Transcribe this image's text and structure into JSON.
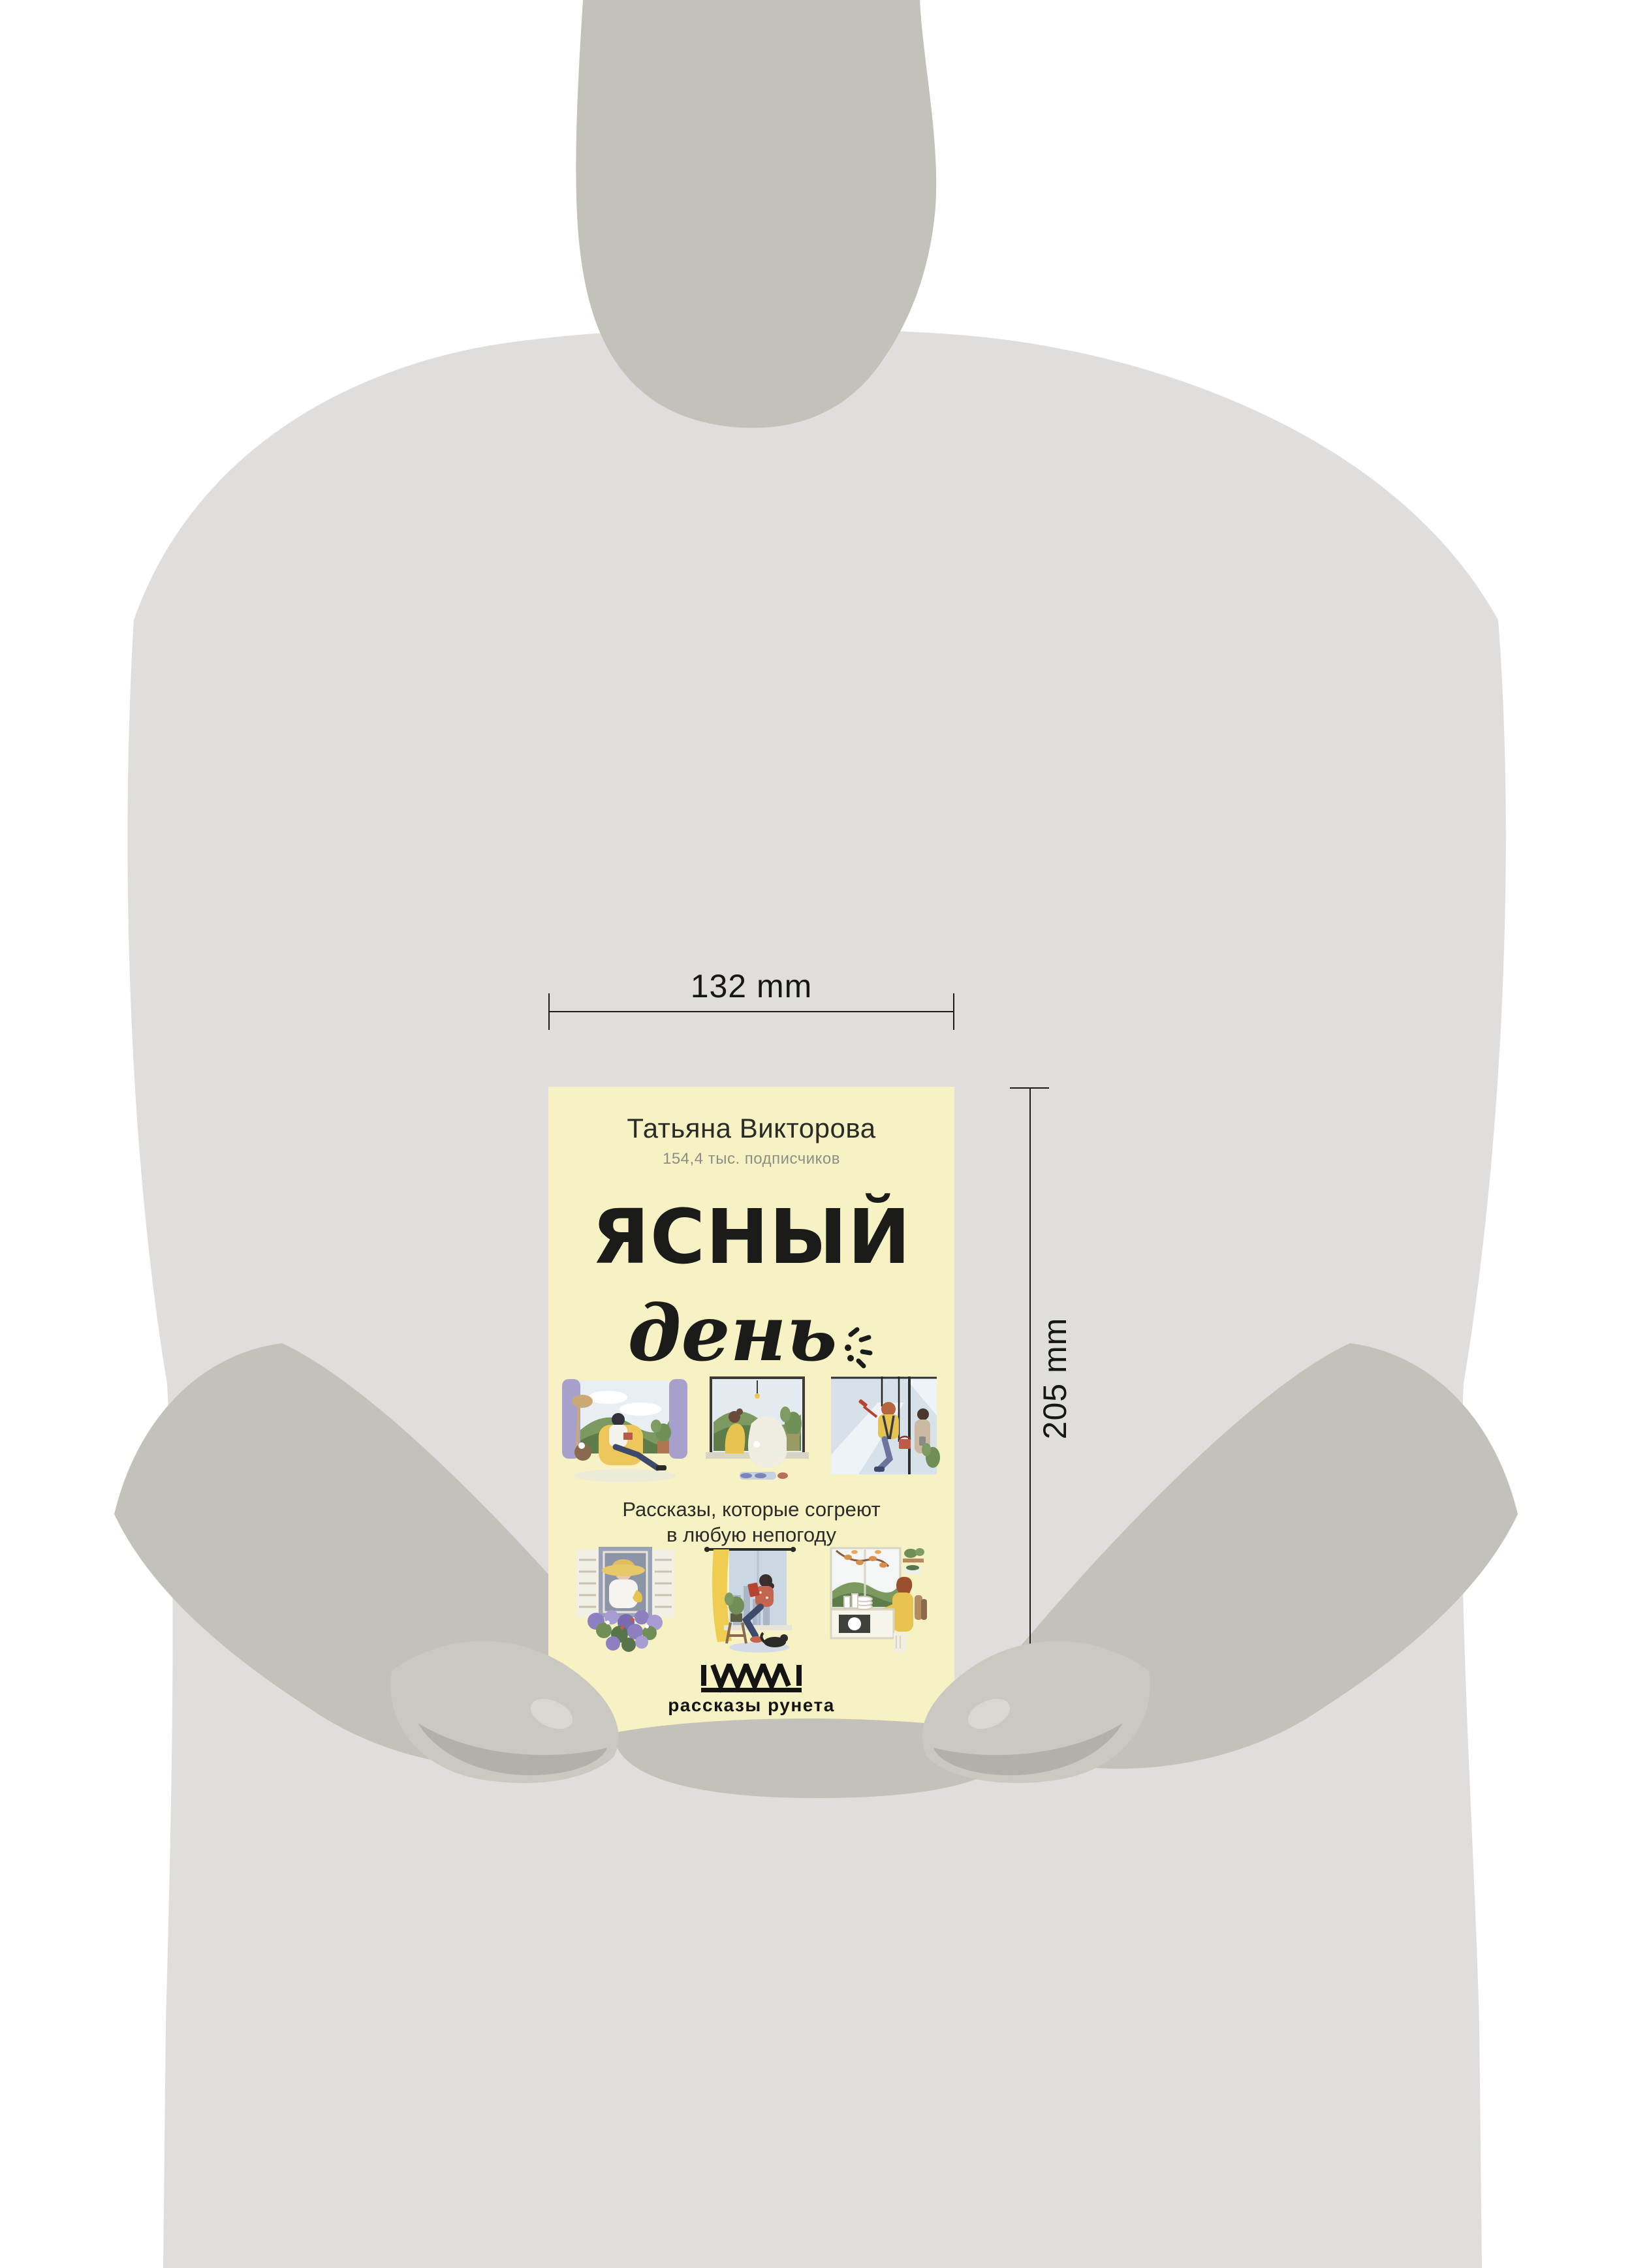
{
  "dimension_annotations": {
    "width_label": "132 mm",
    "height_label": "205 mm",
    "weight_label": "357 g"
  },
  "book_cover": {
    "author": "Татьяна Викторова",
    "subscriber_count": "154,4 тыс. подписчиков",
    "title_line1": "ЯСНЫЙ",
    "title_line2": "день",
    "tagline_line1": "Рассказы, которые согреют",
    "tagline_line2": "в любую непогоду",
    "publisher": "рассказы рунета",
    "cover_color": "#f7f2c4",
    "illustration_names": [
      "man-reading-in-armchair-by-window",
      "two-people-talking-on-window-seat",
      "window-washer-outside-window",
      "woman-in-straw-hat-with-flower-box",
      "woman-reading-on-windowsill-with-cat",
      "woman-washing-dishes-at-window"
    ]
  },
  "silhouette_colors": {
    "body": "#dfdedc",
    "head_and_sleeves": "#c2c1ba",
    "hands": "#c9c8c1",
    "hand_shadow": "#b2b1a9"
  },
  "line_color": "#1c1c1b"
}
